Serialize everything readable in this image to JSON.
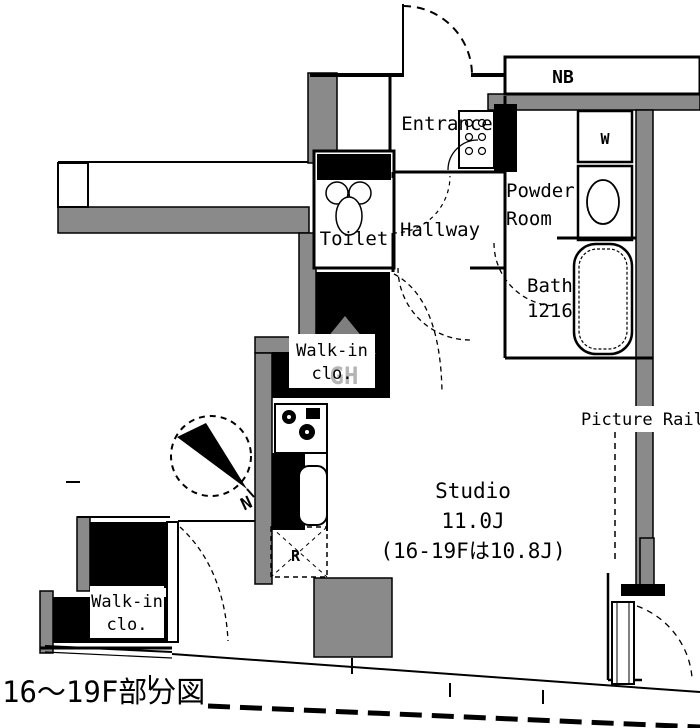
{
  "caption": "16〜19F部分図",
  "colors": {
    "wall-gray": "#8a8a8a",
    "ink": "#000000",
    "watermark": "#a9a9a9"
  },
  "labels": {
    "nb": "NB",
    "washer": "W",
    "entrance": "Entrance",
    "toilet": "Toilet",
    "hallway": "Hallway",
    "powder1": "Powder",
    "powder2": "Room",
    "bath1": "Bath",
    "bath2": "1216",
    "walkin_mid1": "Walk-in",
    "walkin_mid2": "clo.",
    "walkin_bottom1": "Walk-in",
    "walkin_bottom2": "clo.",
    "studio1": "Studio",
    "studio2": "11.0J",
    "studio3": "(16-19Fは10.8J)",
    "picture_rail": "Picture Rail",
    "fridge": "R",
    "north": "N",
    "watermark": "GH"
  }
}
